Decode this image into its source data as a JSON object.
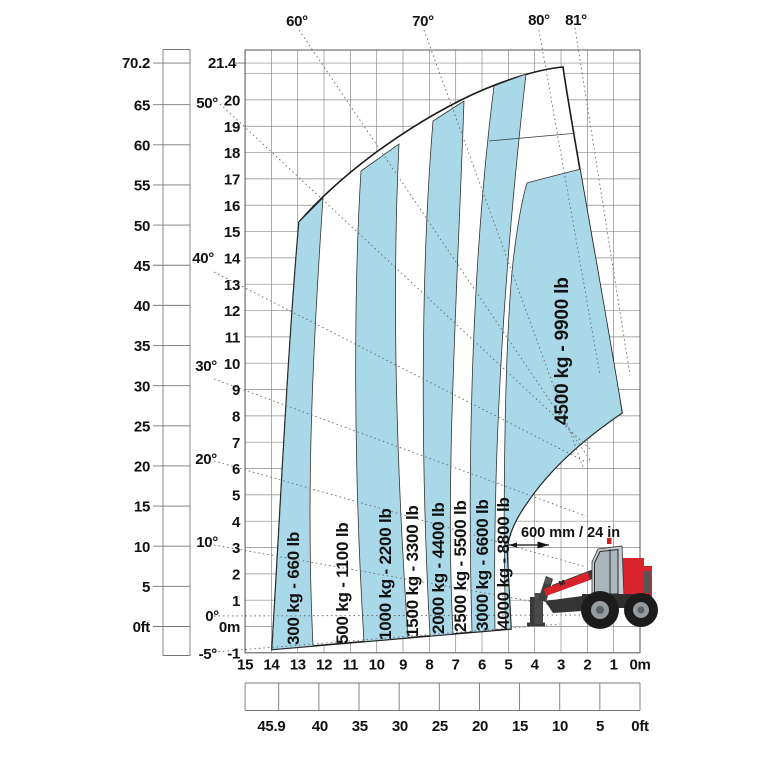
{
  "chart_data": {
    "type": "area",
    "title": "Telehandler load capacity chart",
    "zones": [
      {
        "capacity_kg": 300,
        "capacity_lb": 660,
        "label": "300 kg - 660 lb",
        "fill": "blue"
      },
      {
        "capacity_kg": 500,
        "capacity_lb": 1100,
        "label": "500 kg - 1100 lb",
        "fill": "white"
      },
      {
        "capacity_kg": 1000,
        "capacity_lb": 2200,
        "label": "1000 kg - 2200 lb",
        "fill": "blue"
      },
      {
        "capacity_kg": 1500,
        "capacity_lb": 3300,
        "label": "1500 kg - 3300 lb",
        "fill": "white"
      },
      {
        "capacity_kg": 2000,
        "capacity_lb": 4400,
        "label": "2000 kg - 4400 lb",
        "fill": "blue"
      },
      {
        "capacity_kg": 2500,
        "capacity_lb": 5500,
        "label": "2500 kg - 5500 lb",
        "fill": "white"
      },
      {
        "capacity_kg": 3000,
        "capacity_lb": 6600,
        "label": "3000 kg - 6600 lb",
        "fill": "blue"
      },
      {
        "capacity_kg": 4000,
        "capacity_lb": 8800,
        "label": "4000 kg - 8800 lb",
        "fill": "white"
      },
      {
        "capacity_kg": 4500,
        "capacity_lb": 9900,
        "label": "4500 kg - 9900 lb",
        "fill": "blue"
      }
    ],
    "y_axis_ft": {
      "ticks": [
        "70.2",
        "65",
        "60",
        "55",
        "50",
        "45",
        "40",
        "35",
        "30",
        "25",
        "20",
        "15",
        "10",
        "5",
        "0ft"
      ],
      "range": [
        0,
        70.2
      ]
    },
    "y_axis_m": {
      "ticks": [
        "21.4",
        "20",
        "19",
        "18",
        "17",
        "16",
        "15",
        "14",
        "13",
        "12",
        "11",
        "10",
        "9",
        "8",
        "7",
        "6",
        "5",
        "4",
        "3",
        "2",
        "1",
        "0m",
        "-1"
      ],
      "range": [
        -1,
        21.4
      ]
    },
    "x_axis_m": {
      "ticks": [
        "15",
        "14",
        "13",
        "12",
        "11",
        "10",
        "9",
        "8",
        "7",
        "6",
        "5",
        "4",
        "3",
        "2",
        "1",
        "0m"
      ],
      "range": [
        15,
        0
      ]
    },
    "x_axis_ft": {
      "ticks": [
        "45.9",
        "40",
        "35",
        "30",
        "25",
        "20",
        "15",
        "10",
        "5",
        "0ft"
      ],
      "range": [
        45.9,
        0
      ]
    },
    "angle_labels_left": [
      "50°",
      "40°",
      "30°",
      "20°",
      "10°",
      "0°",
      "-5°"
    ],
    "angle_labels_top": [
      "60°",
      "70°",
      "80°",
      "81°"
    ],
    "annotation_600mm": "600 mm / 24 in",
    "max_lift_height": {
      "m": 21.4,
      "ft": 70.2
    },
    "max_reach": {
      "m": 14,
      "ft": 45.9
    },
    "legend_position": "none",
    "grid": true,
    "colors": {
      "band_blue": "#a9d8e8",
      "machine_red": "#d8232a",
      "cab_gray": "#c7ced3",
      "tire_black": "#1c1c1c"
    }
  }
}
